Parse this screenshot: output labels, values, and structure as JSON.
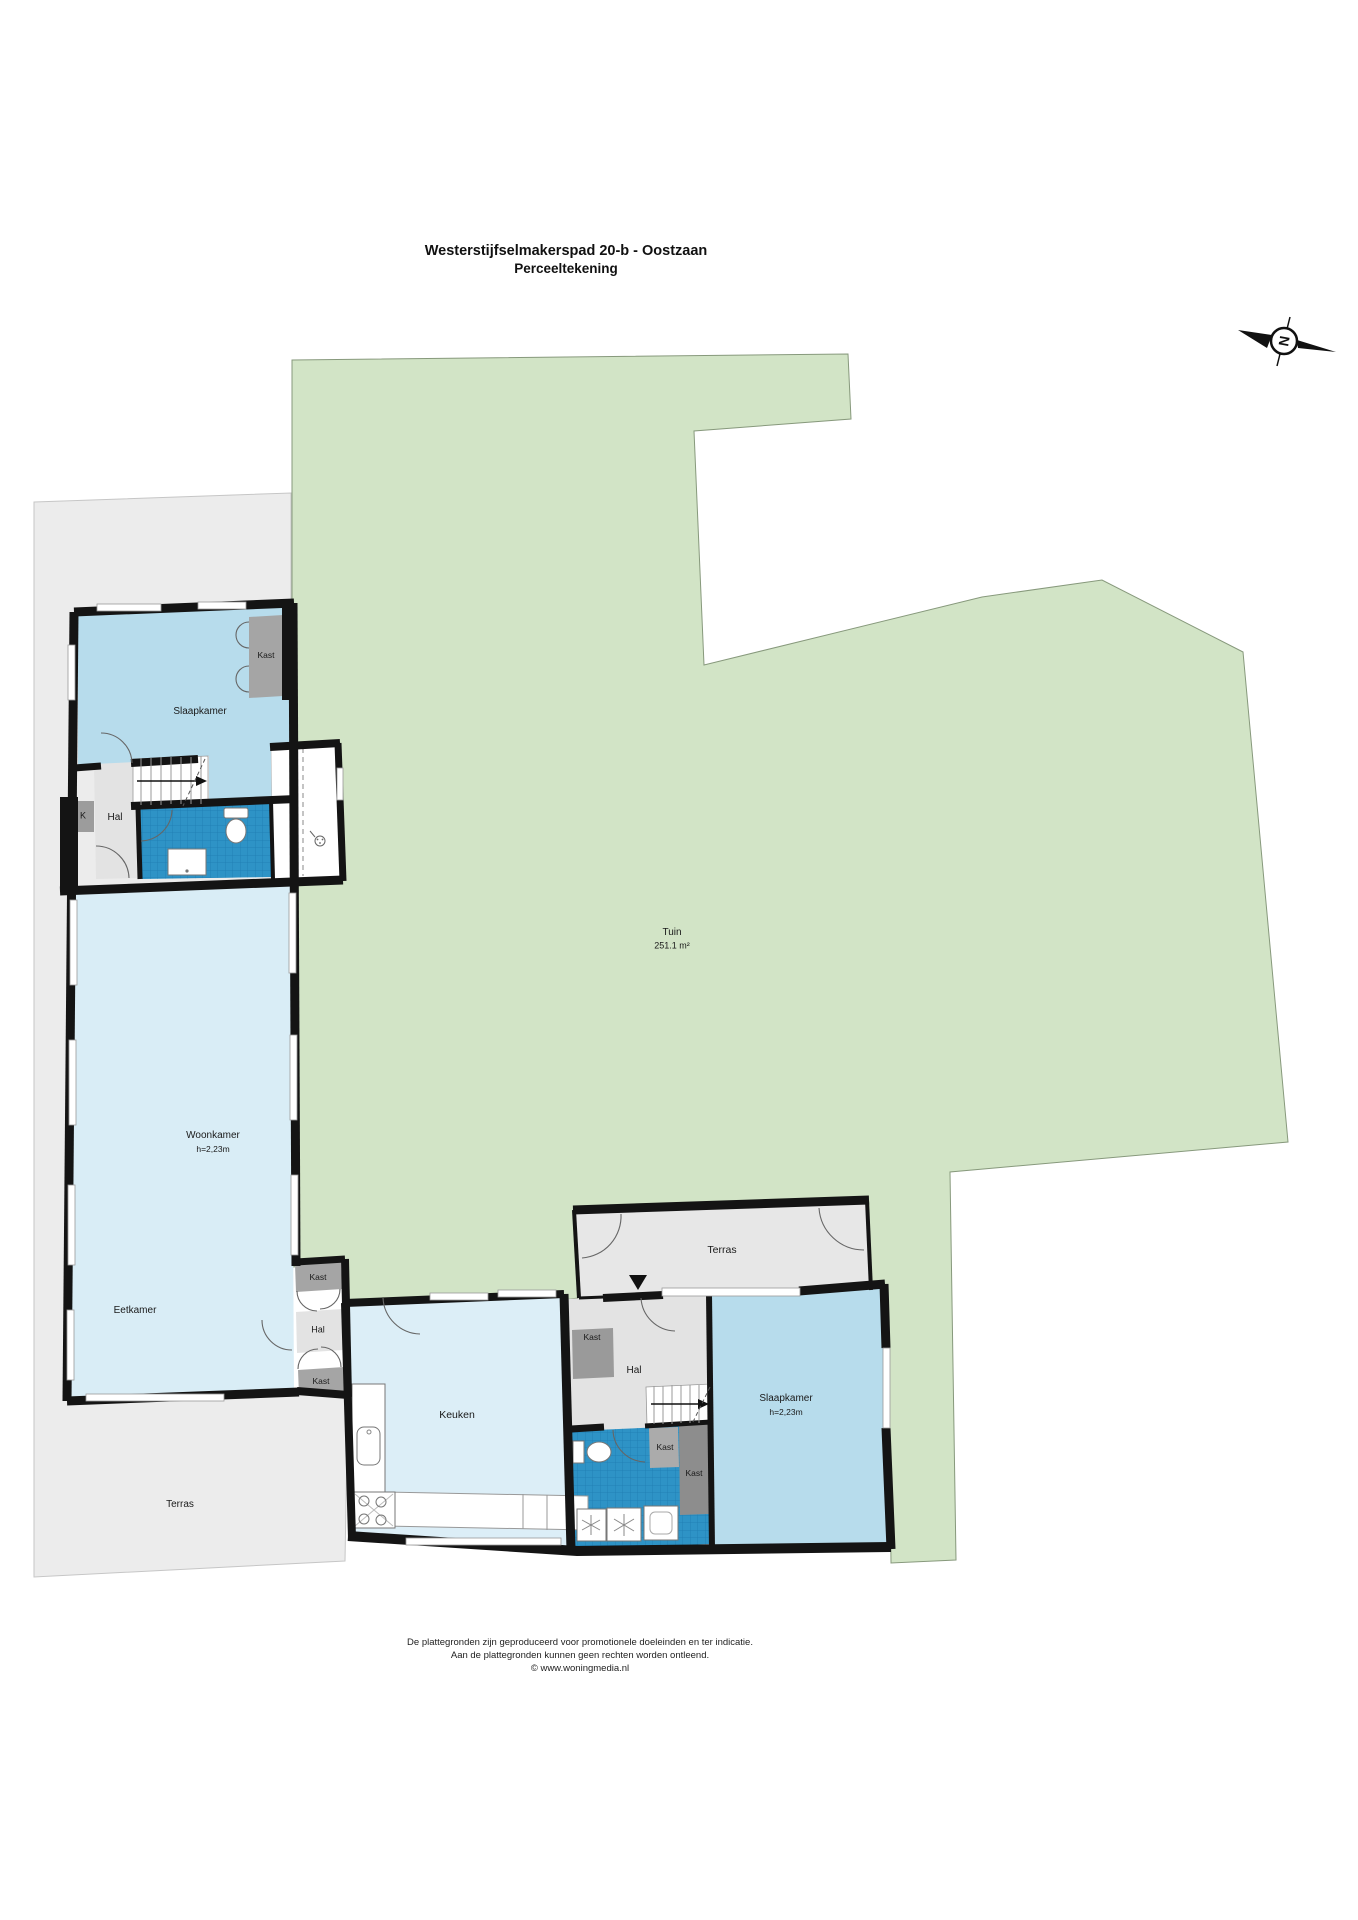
{
  "title": {
    "line1": "Westerstijfselmakerspad 20-b - Oostzaan",
    "line2": "Perceeltekening"
  },
  "compass": {
    "north_label": "N"
  },
  "garden": {
    "name": "Tuin",
    "area": "251.1 m²"
  },
  "rooms": {
    "slaapkamer1": "Slaapkamer",
    "hal1": "Hal",
    "k_closet": "K",
    "woonkamer": "Woonkamer",
    "woonkamer_height": "h=2,23m",
    "eetkamer": "Eetkamer",
    "keuken": "Keuken",
    "terras_left": "Terras",
    "terras_top": "Terras",
    "hal_mid": "Hal",
    "hal2": "Hal",
    "slaapkamer2": "Slaapkamer",
    "slaapkamer2_height": "h=2,23m"
  },
  "closets": {
    "kast1": "Kast",
    "kast_col_top": "Kast",
    "kast_col_bottom": "Kast",
    "kast_hal2": "Kast",
    "kast_small": "Kast",
    "kast_dark": "Kast"
  },
  "footer": {
    "line1": "De plattegronden zijn geproduceerd voor promotionele doeleinden en ter indicatie.",
    "line2": "Aan de plattegronden kunnen geen rechten worden ontleend.",
    "line3": "© www.woningmedia.nl"
  },
  "colors": {
    "garden": "#d2e4c6",
    "garden_edge": "#87997c",
    "terrace": "#ececec",
    "terrace2": "#e7e7e7",
    "bedroom": "#b7dcec",
    "living": "#d9edf6",
    "kitchen": "#dceef7",
    "tile": "#2e93c6",
    "tile_grid": "#1d7db2",
    "hal": "#e3e3e3",
    "kast": "#a5a5a5",
    "kast_dark": "#8d8d8d",
    "wall": "#141414"
  }
}
